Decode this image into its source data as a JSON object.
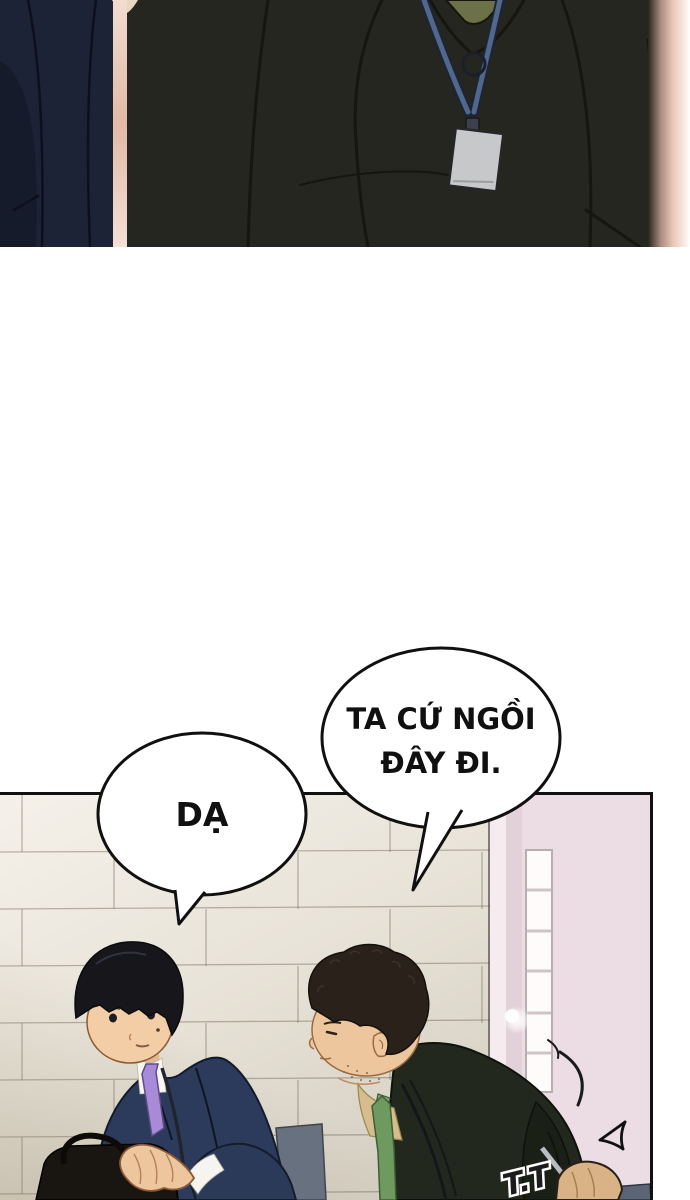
{
  "dialogue": {
    "boss_bubble": {
      "line1": "TA CỨ NGỒI",
      "line2": "ĐÂY ĐI."
    },
    "reply_bubble": {
      "text": "DẠ"
    }
  },
  "sfx": {
    "label": "T.T"
  },
  "icons": {
    "speed_arrow": "manga-speed-tick",
    "motion_lines": "manga-motion-arc"
  },
  "colors": {
    "suit_olive_dark": "#25261f",
    "suit_navy_top": "#1d2336",
    "rim_light_pink": "#e2b9a6",
    "badge_gray": "#c7c8ca",
    "lanyard_blue": "#51678c",
    "collar_green": "#6d7147",
    "tile_cream": "#efeae1",
    "door_pink": "#ebdde3",
    "window_white": "#fdfcfa",
    "suit_navy_bottom": "#2c3b5c",
    "tie_purple": "#a78bd8",
    "tie_green": "#6f9a5f",
    "shirt_tan": "#d6bd8d",
    "jacket_dark_green": "#23281e",
    "skin_tone": "#f3cda6",
    "chair_gray": "#68717f",
    "briefcase_black": "#191510"
  }
}
